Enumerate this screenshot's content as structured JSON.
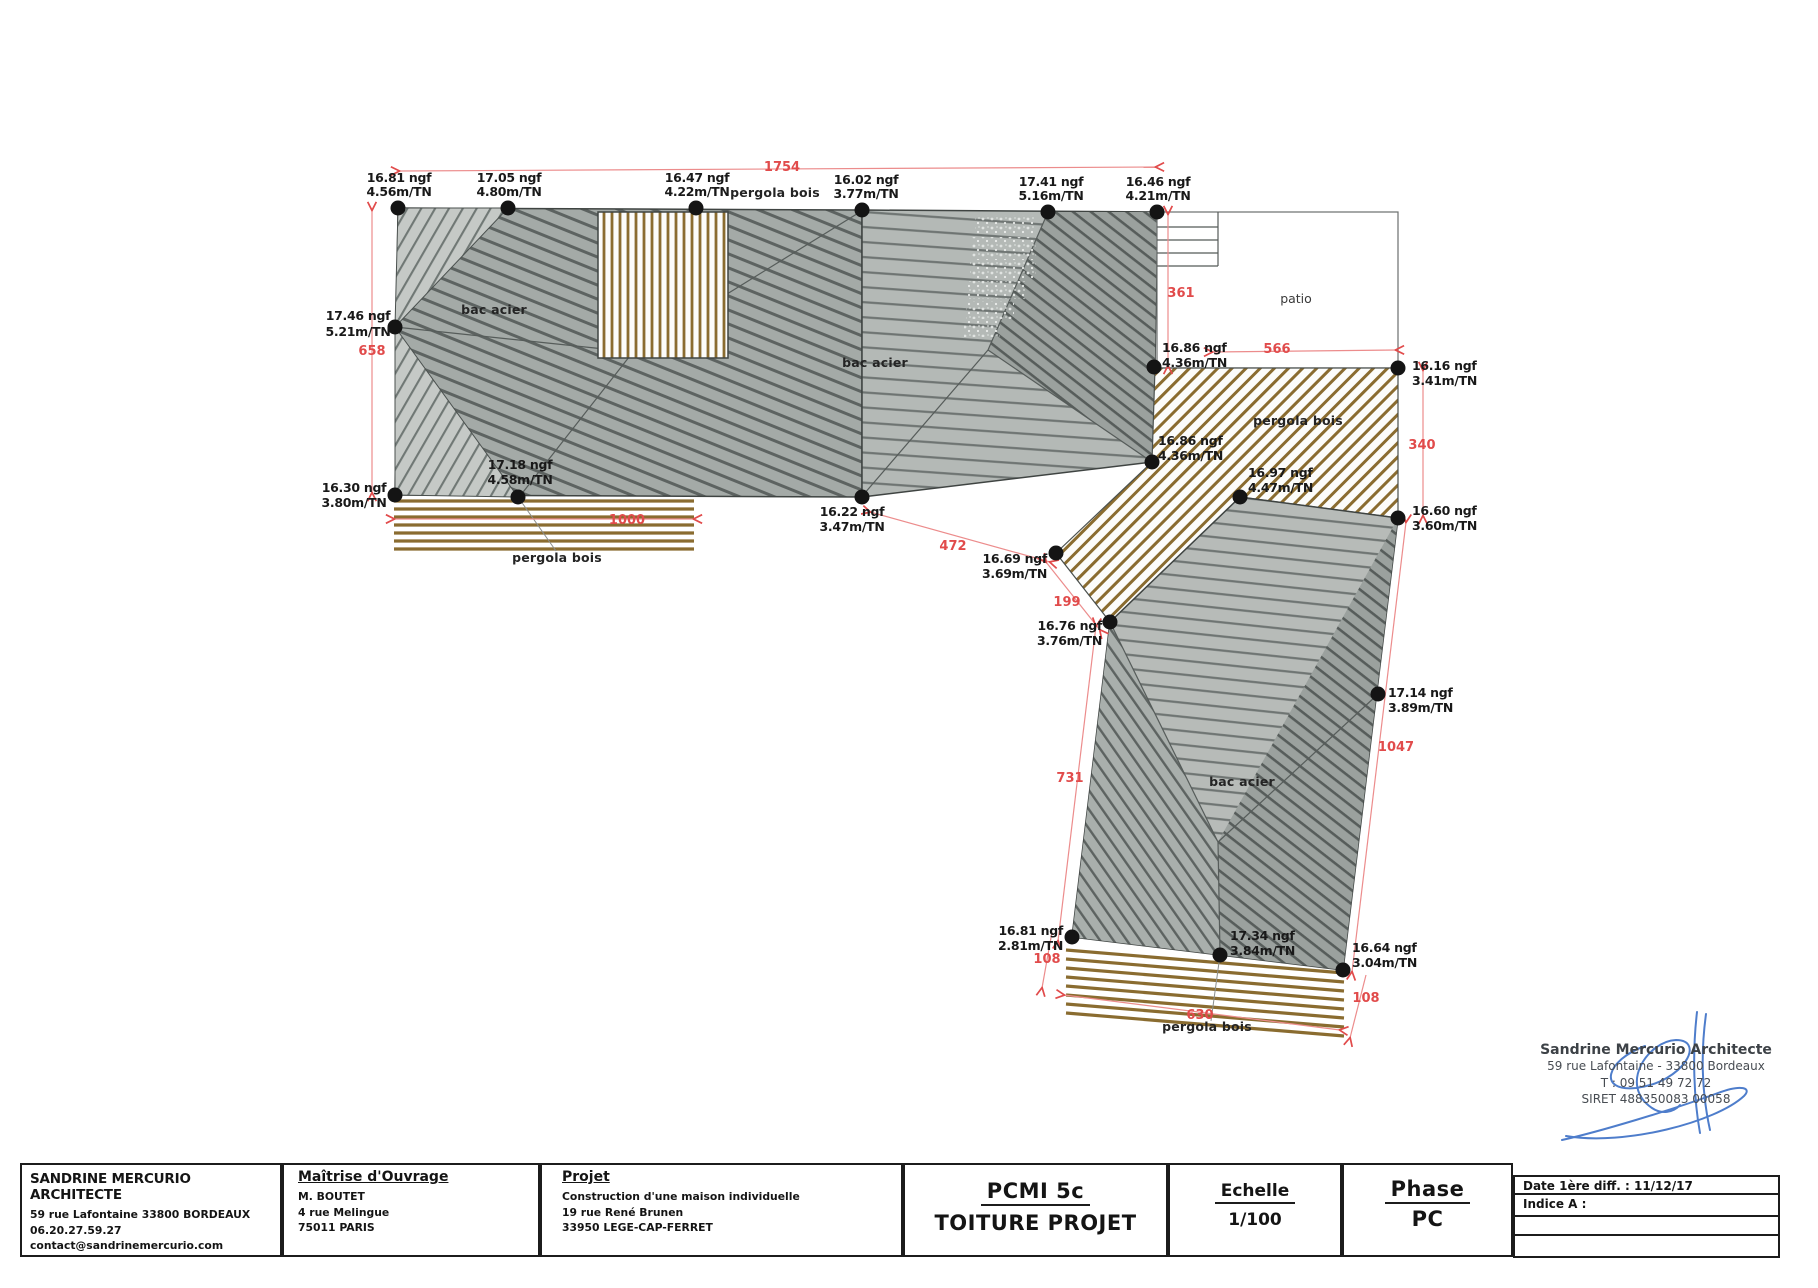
{
  "drawing": {
    "points": {
      "p1": {
        "ngf": "16.81 ngf",
        "tn": "4.56m/TN"
      },
      "p2": {
        "ngf": "17.05 ngf",
        "tn": "4.80m/TN"
      },
      "p3": {
        "ngf": "16.47 ngf",
        "tn": "4.22m/TN"
      },
      "p4": {
        "ngf": "16.02 ngf",
        "tn": "3.77m/TN"
      },
      "p5": {
        "ngf": "17.41 ngf",
        "tn": "5.16m/TN"
      },
      "p6": {
        "ngf": "16.46 ngf",
        "tn": "4.21m/TN"
      },
      "p7": {
        "ngf": "17.46 ngf",
        "tn": "5.21m/TN"
      },
      "p8": {
        "ngf": "16.30 ngf",
        "tn": "3.80m/TN"
      },
      "p9": {
        "ngf": "17.18 ngf",
        "tn": "4.58m/TN"
      },
      "p10": {
        "ngf": "16.22 ngf",
        "tn": "3.47m/TN"
      },
      "p11": {
        "ngf": "16.86 ngf",
        "tn": "4.36m/TN"
      },
      "p12": {
        "ngf": "16.86 ngf",
        "tn": "4.36m/TN"
      },
      "p13": {
        "ngf": "16.97 ngf",
        "tn": "4.47m/TN"
      },
      "p14": {
        "ngf": "16.16 ngf",
        "tn": "3.41m/TN"
      },
      "p15": {
        "ngf": "16.60 ngf",
        "tn": "3.60m/TN"
      },
      "p16": {
        "ngf": "16.69 ngf",
        "tn": "3.69m/TN"
      },
      "p17": {
        "ngf": "16.76 ngf",
        "tn": "3.76m/TN"
      },
      "p18": {
        "ngf": "17.14 ngf",
        "tn": "3.89m/TN"
      },
      "p19": {
        "ngf": "16.81 ngf",
        "tn": "2.81m/TN"
      },
      "p20": {
        "ngf": "17.34 ngf",
        "tn": "3.84m/TN"
      },
      "p21": {
        "ngf": "16.64 ngf",
        "tn": "3.04m/TN"
      }
    },
    "dimensions": {
      "top": "1754",
      "left": "658",
      "pergola_left": "1000",
      "d472": "472",
      "d199": "199",
      "d361": "361",
      "d566": "566",
      "d340": "340",
      "d731": "731",
      "d1047": "1047",
      "d108_left": "108",
      "d108_right": "108",
      "d630": "630"
    },
    "labels": {
      "bac_acier": "bac acier",
      "pergola_bois": "pergola bois",
      "patio": "patio"
    },
    "colors": {
      "dimension_red": "#e14b4b",
      "pergola_brown": "#8a6c30",
      "roof_gray": "#a4aaa7",
      "signature_blue": "#3b6fc6"
    }
  },
  "stamp": {
    "line1": "Sandrine Mercurio Architecte",
    "line2": "59 rue Lafontaine - 33800 Bordeaux",
    "line3": "T : 09 51 49 72 72",
    "line4": "SIRET 488350083 00058"
  },
  "titleblock": {
    "architect": {
      "name": "SANDRINE MERCURIO ARCHITECTE",
      "address": "59 rue Lafontaine 33800 BORDEAUX",
      "phone": "06.20.27.59.27",
      "email": "contact@sandrinemercurio.com"
    },
    "moa": {
      "title": "Maîtrise d'Ouvrage",
      "name": "M. BOUTET",
      "address1": "4 rue Melingue",
      "address2": "75011 PARIS"
    },
    "projet": {
      "title": "Projet",
      "line1": "Construction d'une maison individuelle",
      "line2": "19 rue René Brunen",
      "line3": "33950 LEGE-CAP-FERRET"
    },
    "doc": {
      "code": "PCMI 5c",
      "name": "TOITURE PROJET"
    },
    "echelle": {
      "title": "Echelle",
      "value": "1/100"
    },
    "phase": {
      "title": "Phase",
      "value": "PC"
    },
    "revisions": {
      "date": "Date 1ère diff. : 11/12/17",
      "indice": "Indice A :"
    }
  }
}
